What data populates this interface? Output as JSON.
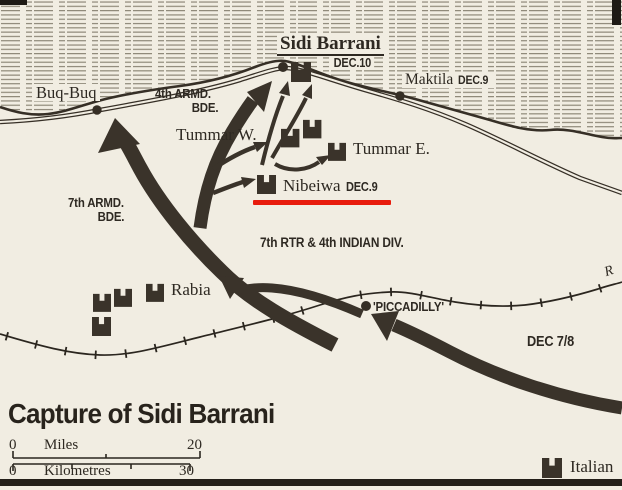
{
  "title": "Capture of Sidi Barrani",
  "legend": {
    "symbol": "fort-icon",
    "label": "Italian"
  },
  "scale_bar": {
    "miles": {
      "start": "0",
      "label": "Miles",
      "end": "20"
    },
    "kilometres": {
      "start": "0",
      "label": "Kilometres",
      "end": "30"
    }
  },
  "places": {
    "sidi_barrani": {
      "name": "Sidi Barrani",
      "date": "DEC.10"
    },
    "maktila": {
      "name": "Maktila",
      "date": "DEC.9"
    },
    "buq_buq": {
      "name": "Buq-Buq"
    },
    "tummar_w": {
      "name": "Tummar W."
    },
    "tummar_e": {
      "name": "Tummar E."
    },
    "nibeiwa": {
      "name": "Nibeiwa",
      "date": "DEC.9"
    },
    "rabia": {
      "name": "Rabia"
    },
    "piccadilly": {
      "name": "'PICCADILLY'"
    },
    "edge_label": {
      "name": "R"
    }
  },
  "units": {
    "armd4": {
      "line1": "4th ARMD.",
      "line2": "BDE."
    },
    "armd7": {
      "line1": "7th ARMD.",
      "line2": "BDE."
    },
    "rtr7": {
      "label": "7th RTR & 4th INDIAN DIV."
    },
    "dec78": {
      "label": "DEC 7/8"
    }
  },
  "colors": {
    "paper": "#f1ede2",
    "ink": "#362f26",
    "sea_hatch": "#8e8878",
    "red_annotation": "#e81c0d"
  }
}
